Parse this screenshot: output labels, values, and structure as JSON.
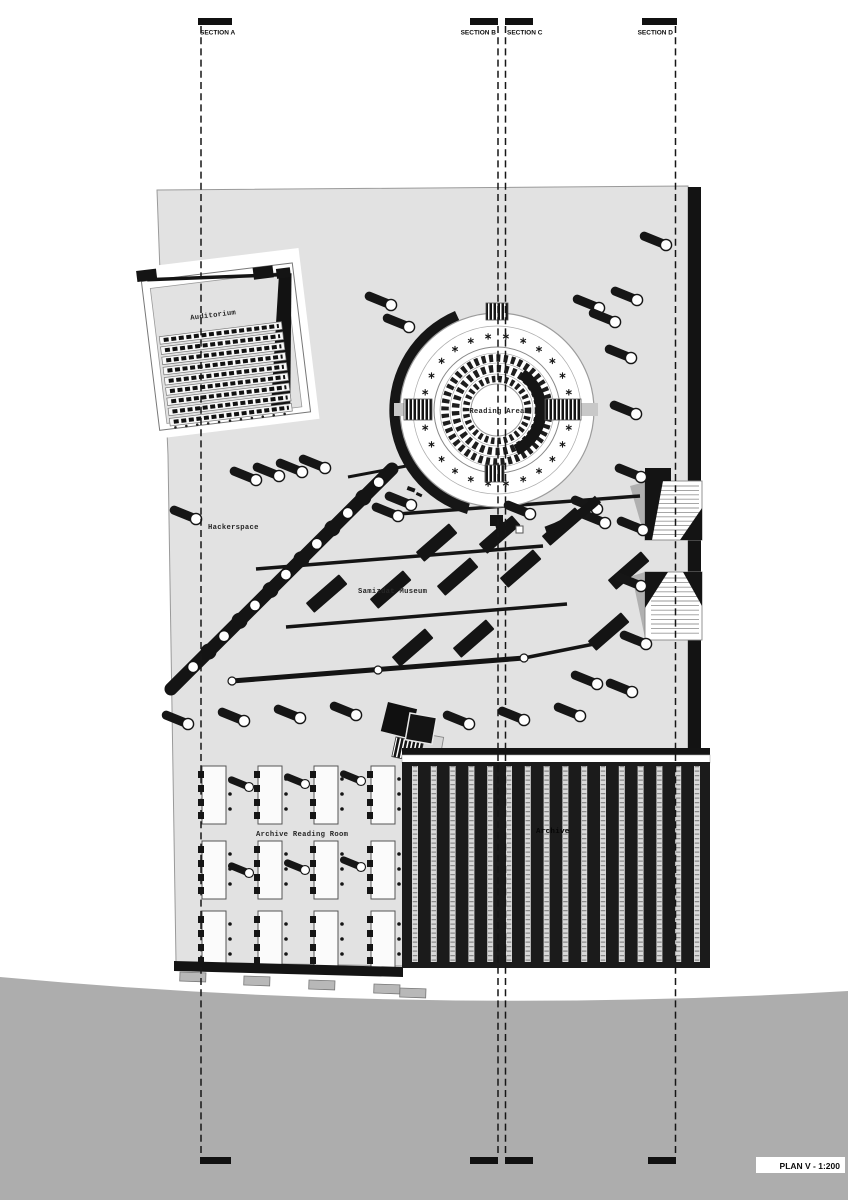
{
  "plan": {
    "title": "PLAN V - 1:200"
  },
  "sections": [
    {
      "label": "SECTION A"
    },
    {
      "label": "SECTION B"
    },
    {
      "label": "SECTION C"
    },
    {
      "label": "SECTION D"
    }
  ],
  "rooms": {
    "auditorium": "Auditorium",
    "reading_area": "Reading Area",
    "hackerspace": "Hackerspace",
    "samizdat_museum": "Samizdat Museum",
    "archive": "Archive",
    "archive_reading_room": "Archive Reading Room"
  },
  "colors": {
    "plate": "#e2e2e2",
    "ink": "#161616",
    "ground": "#adadad",
    "paper": "#ffffff"
  }
}
